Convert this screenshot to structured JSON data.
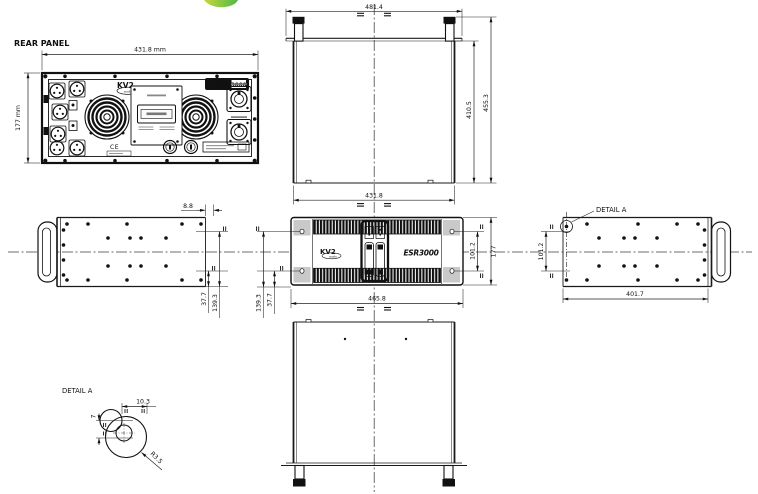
{
  "colors": {
    "line": "#1a1a1a",
    "accent_green": "#7fc243",
    "panel_gray": "#c9c9c9"
  },
  "rear_panel": {
    "label": "REAR PANEL",
    "dim_width": "431.8 mm",
    "dim_height": "177 mm",
    "brand": "KV2",
    "brand_sub": "audio",
    "badge_model": "ESR",
    "badge_number": "3000",
    "ce_mark": "CE"
  },
  "top_view": {
    "dim_overall_width": "481.4",
    "dim_overall_depth": "455.3",
    "dim_body_depth": "410.5",
    "dim_body_width": "431.8"
  },
  "front_view": {
    "brand": "KV2",
    "brand_sub": "audio",
    "model": "ESR3000",
    "dim_width": "465.8",
    "dim_height": "177",
    "dim_hole_span": "101.2",
    "dim_hole_upper": "139.3",
    "dim_hole_lower": "37.7"
  },
  "left_view": {
    "dim_rear_offset": "8.8",
    "dim_hole_lower": "37.7",
    "dim_hole_upper": "139.3"
  },
  "right_view": {
    "detail_callout": "DETAIL A",
    "dim_hole_span": "101.2",
    "dim_length": "401.7"
  },
  "detail_a": {
    "label": "DETAIL A",
    "dim_width": "10.3",
    "dim_height": "7",
    "dim_radius": "R3.5"
  }
}
